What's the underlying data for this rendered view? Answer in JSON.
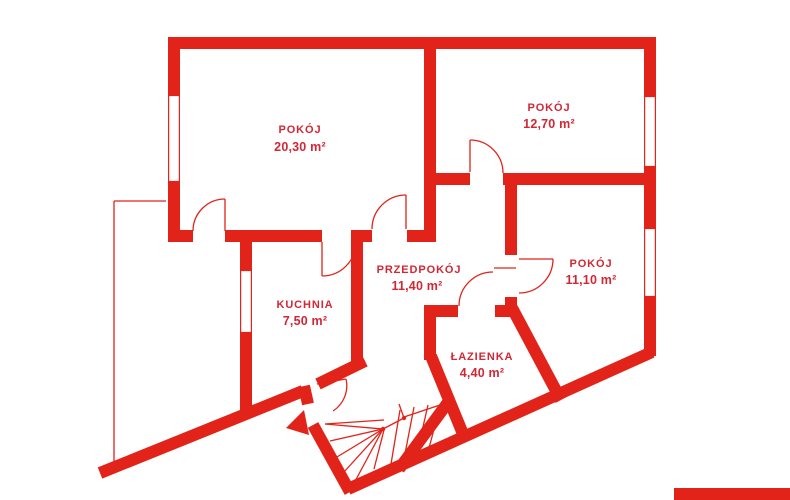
{
  "plan": {
    "title": "Rzut mieszkania",
    "rooms": [
      {
        "id": "pokoj-1",
        "name": "POKÓJ",
        "area": "20,30 m²"
      },
      {
        "id": "pokoj-2",
        "name": "POKÓJ",
        "area": "12,70 m²"
      },
      {
        "id": "pokoj-3",
        "name": "POKÓJ",
        "area": "11,10 m²"
      },
      {
        "id": "przedpokoj",
        "name": "PRZEDPOKÓJ",
        "area": "11,40 m²"
      },
      {
        "id": "kuchnia",
        "name": "KUCHNIA",
        "area": "7,50 m²"
      },
      {
        "id": "lazienka",
        "name": "ŁAZIENKA",
        "area": "4,40 m²"
      }
    ]
  },
  "colors": {
    "wall": "#e2231a",
    "text": "#d22735"
  }
}
